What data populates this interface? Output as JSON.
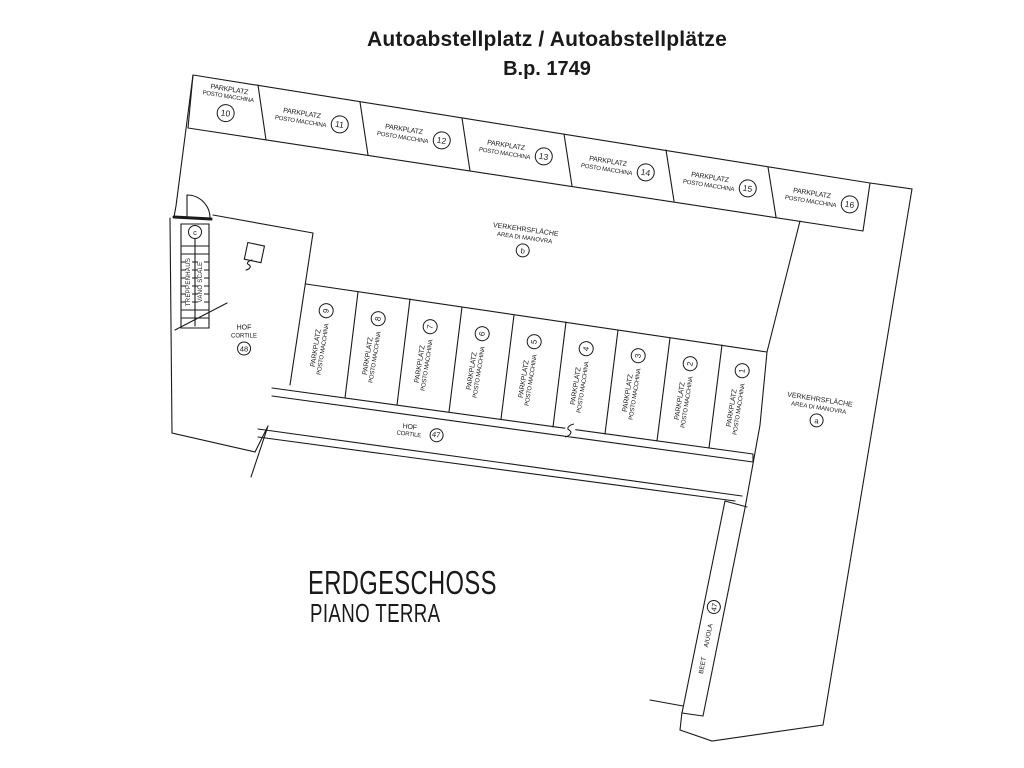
{
  "title": {
    "line1": "Autoabstellplatz / Autoabstellplätze",
    "line2": "B.p. 1749"
  },
  "floor": {
    "de": "ERDGESCHOSS",
    "it": "PIANO TERRA"
  },
  "parking_label": {
    "de": "PARKPLATZ",
    "it": "POSTO MACCHINA"
  },
  "maneuver_label": {
    "de": "VERKEHRSFLÄCHE",
    "it": "AREA DI MANOVRA"
  },
  "court_label": {
    "de": "HOF",
    "it": "CORTILE"
  },
  "bed_label": {
    "de": "BEET",
    "it": "AIUOLA"
  },
  "stair_label": {
    "de": "TREPPENHAUS",
    "it": "VANO SCALE"
  },
  "top_row_numbers": [
    "10",
    "11",
    "12",
    "13",
    "14",
    "15",
    "16"
  ],
  "middle_row_numbers": [
    "9",
    "8",
    "7",
    "6",
    "5",
    "4",
    "3",
    "2",
    "1"
  ],
  "area_ids": {
    "maneuver_top": "b",
    "maneuver_right": "a",
    "court_left": "48",
    "court_mid": "47",
    "bed": "47",
    "stair": "c"
  },
  "colors": {
    "line": "#1a1a1a",
    "background": "#ffffff"
  }
}
